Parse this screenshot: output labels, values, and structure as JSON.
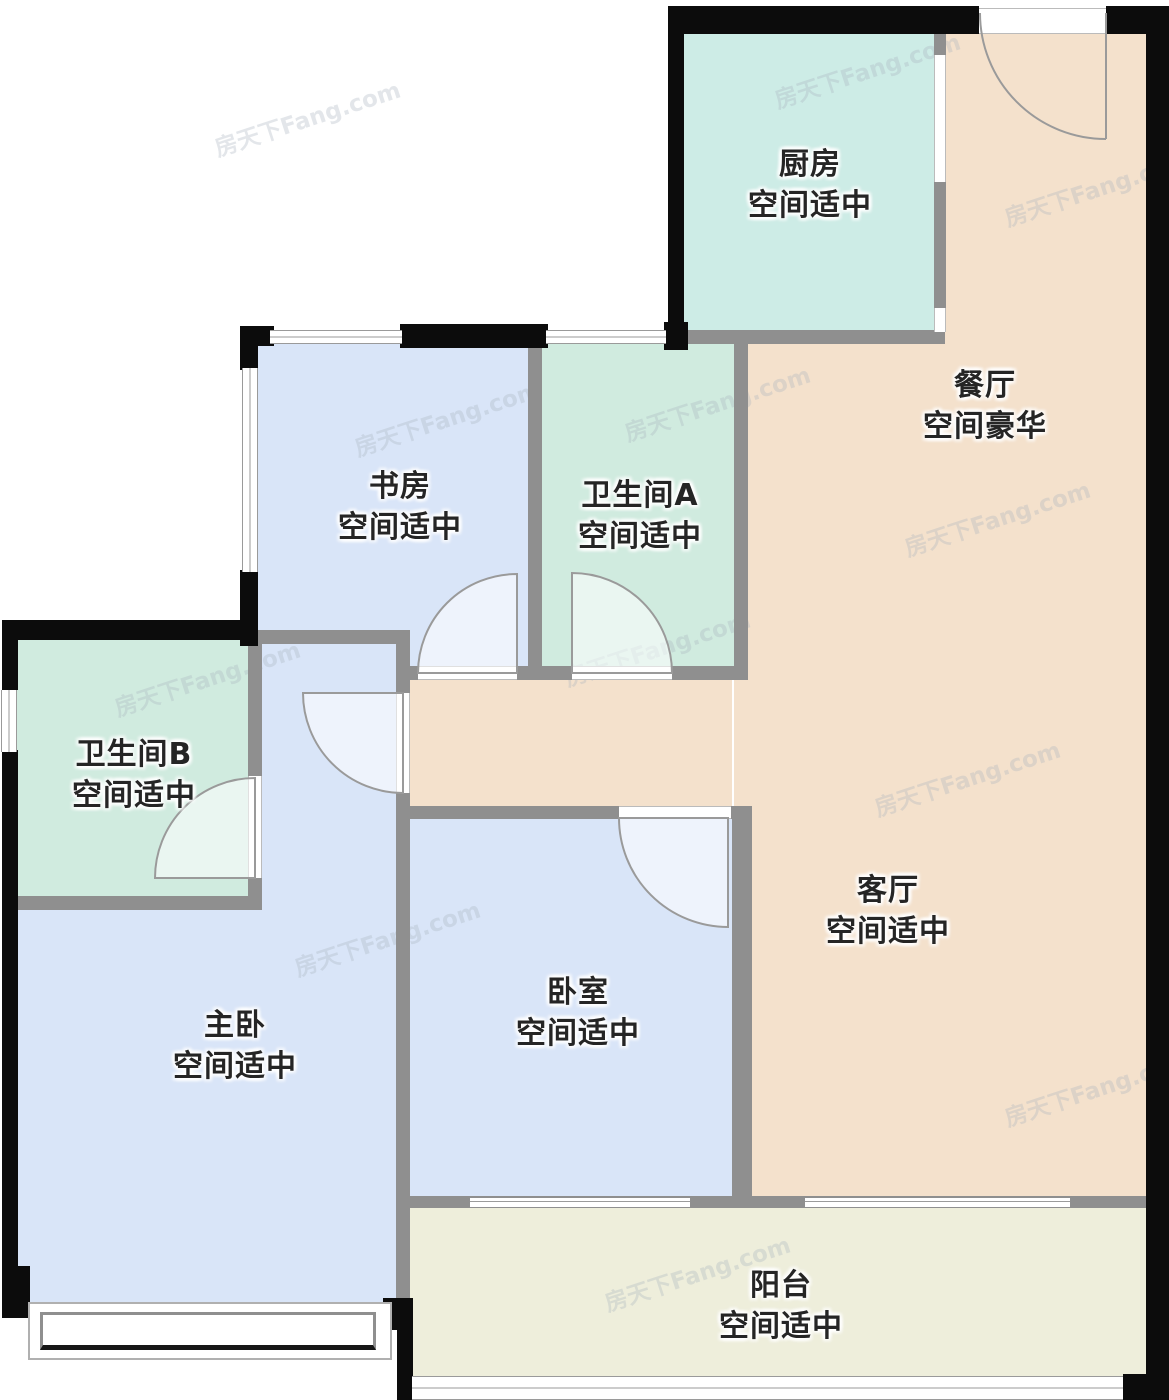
{
  "watermark": "房天下Fang.com",
  "palette": {
    "room_blue": "#d9e5f8",
    "room_mint": "#d0ebdf",
    "room_kitchen_mint": "#cdece6",
    "room_peach": "#f4e1cc",
    "room_cream": "#eeeedb",
    "wall_gray": "#8f8f8f",
    "wall_black": "#0c0c0c"
  },
  "rooms": [
    {
      "id": "kitchen",
      "name": "厨房",
      "grade": "空间适中"
    },
    {
      "id": "dining",
      "name": "餐厅",
      "grade": "空间豪华"
    },
    {
      "id": "study",
      "name": "书房",
      "grade": "空间适中"
    },
    {
      "id": "bathroom-a",
      "name": "卫生间A",
      "grade": "空间适中"
    },
    {
      "id": "bathroom-b",
      "name": "卫生间B",
      "grade": "空间适中"
    },
    {
      "id": "master-bedroom",
      "name": "主卧",
      "grade": "空间适中"
    },
    {
      "id": "bedroom",
      "name": "卧室",
      "grade": "空间适中"
    },
    {
      "id": "living-room",
      "name": "客厅",
      "grade": "空间适中"
    },
    {
      "id": "balcony",
      "name": "阳台",
      "grade": "空间适中"
    }
  ]
}
